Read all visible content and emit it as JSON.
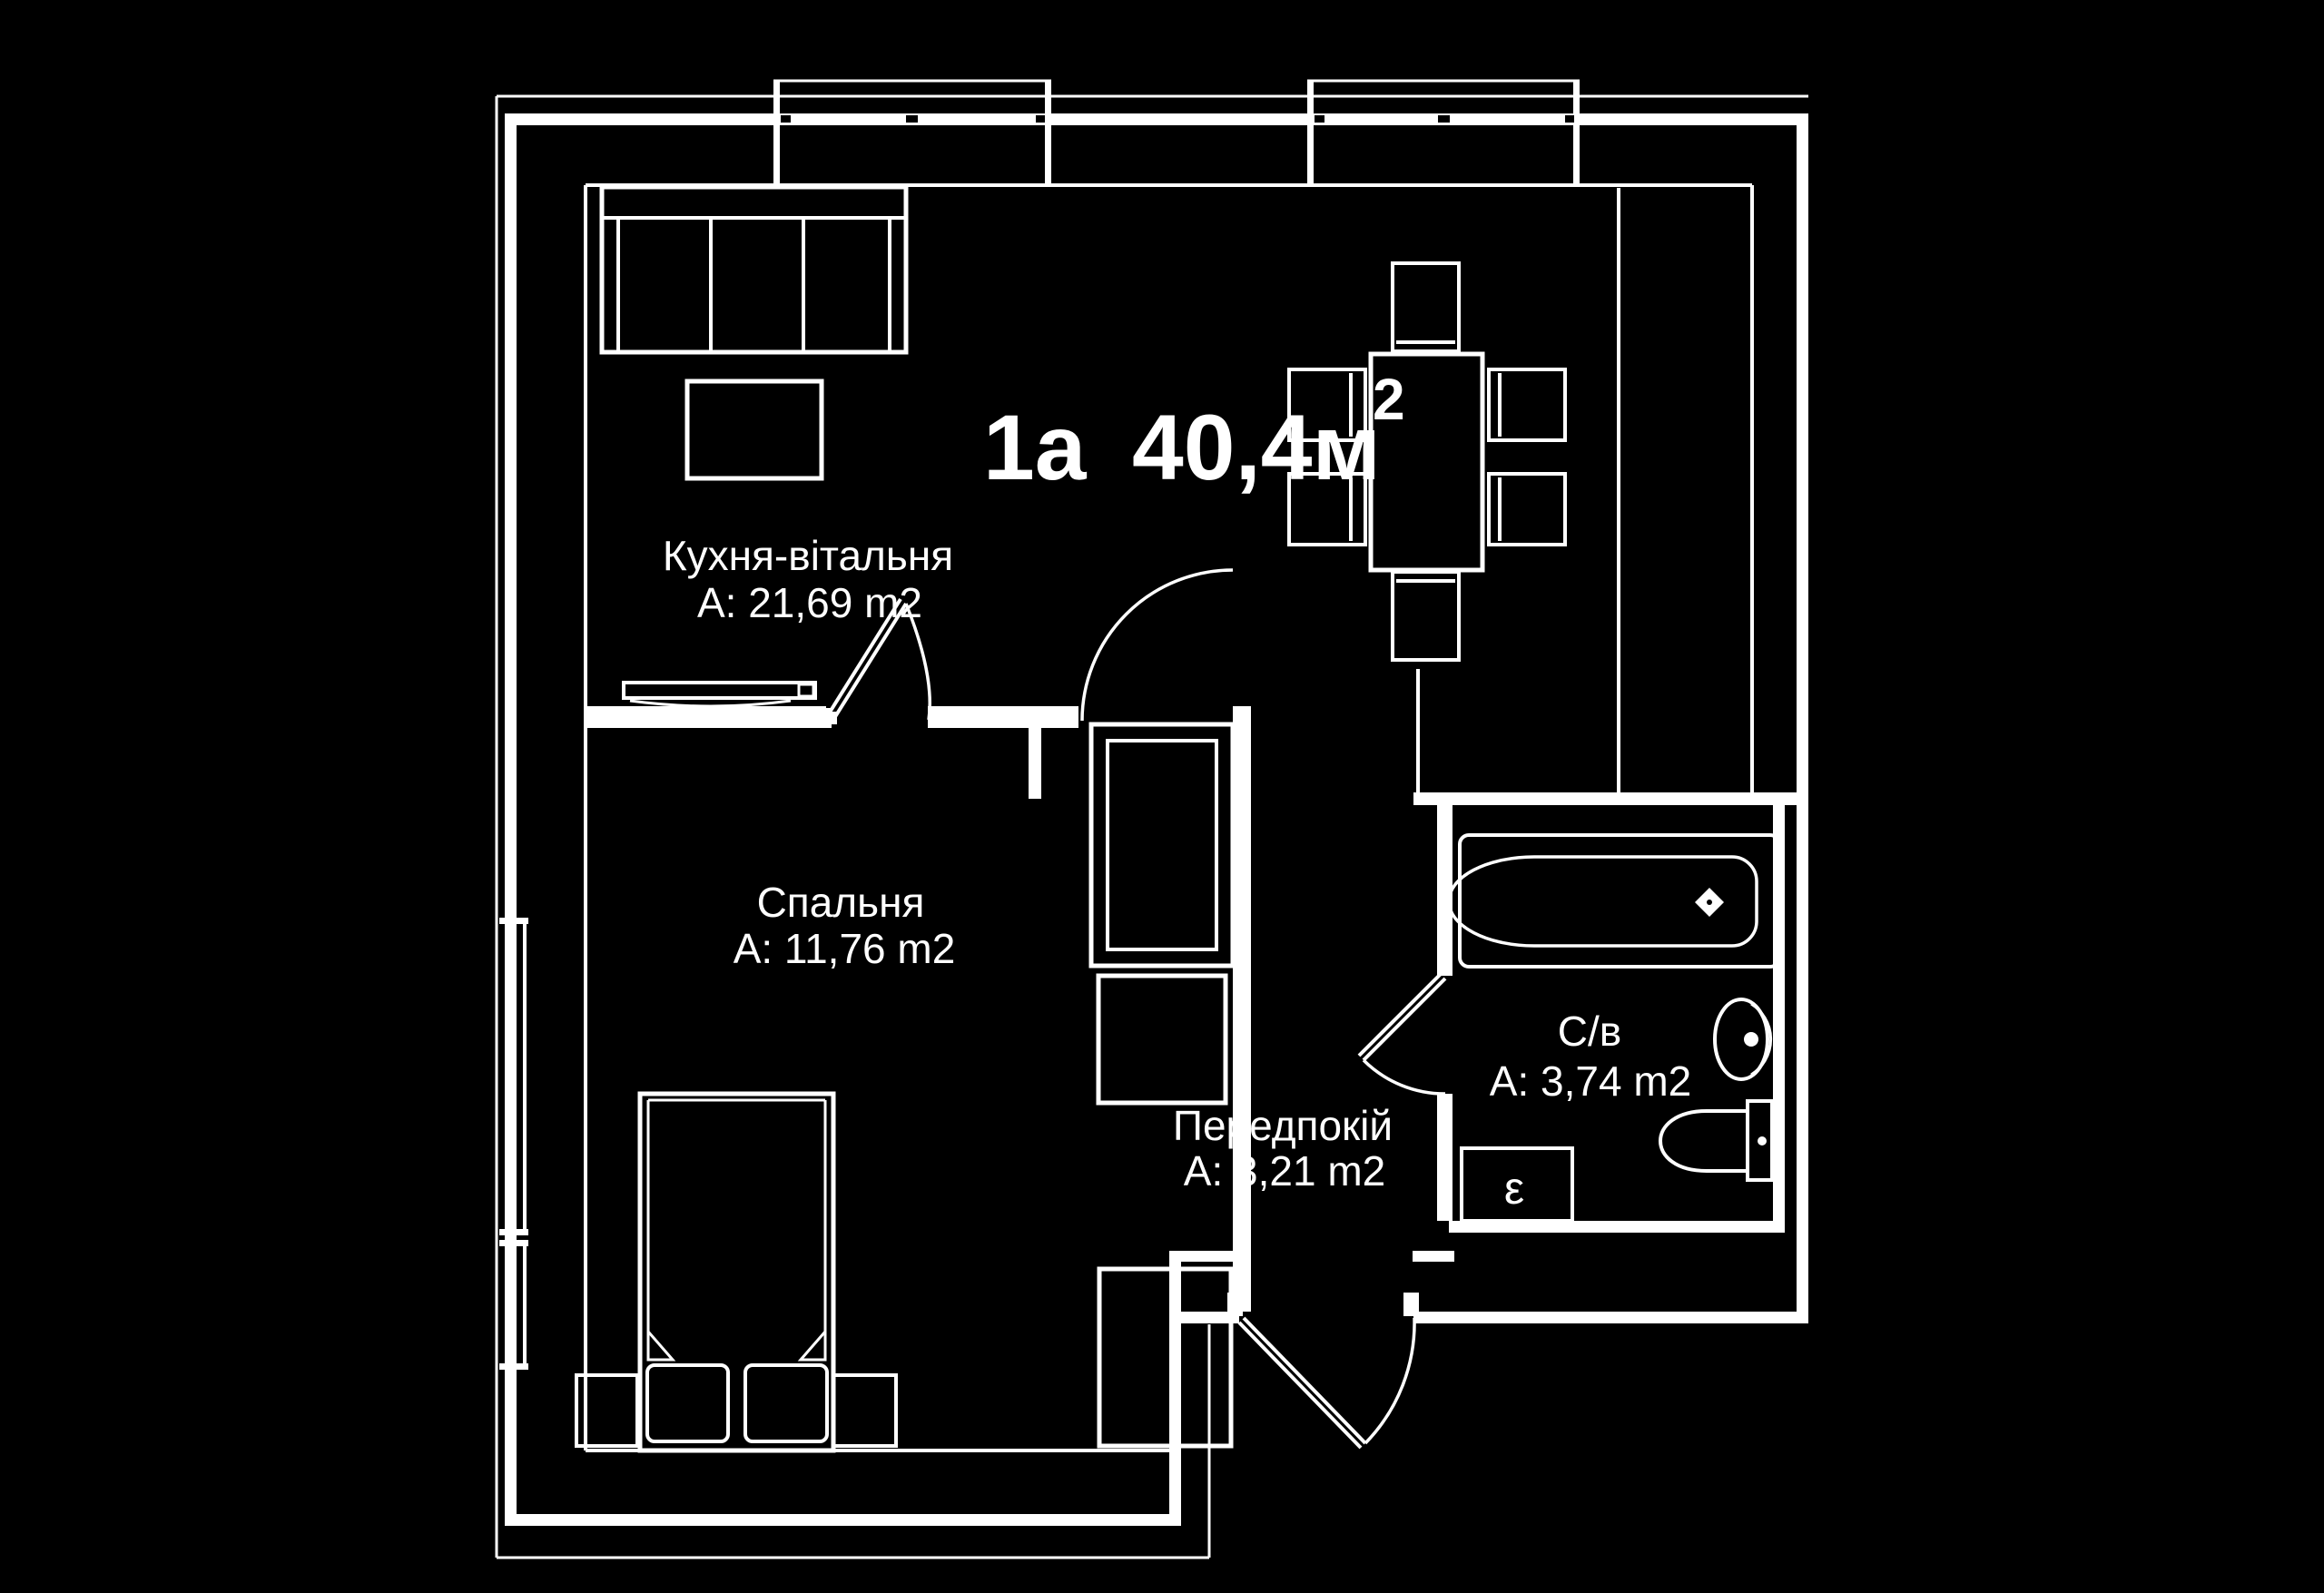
{
  "colors": {
    "background": "#000000",
    "lines": "#ffffff"
  },
  "title": {
    "unit_label": "1a",
    "total_area": "40,4м",
    "area_superscript": "2"
  },
  "rooms": [
    {
      "name": "Кухня-вітальня",
      "area": "A: 21,69 m2"
    },
    {
      "name": "Спальня",
      "area": "A: 11,76 m2"
    },
    {
      "name": "Передпокій",
      "area": "A: 3,21 m2"
    },
    {
      "name": "С/в",
      "area": "A: 3,74 m2"
    }
  ],
  "marks": {
    "duct_label": "ε"
  }
}
